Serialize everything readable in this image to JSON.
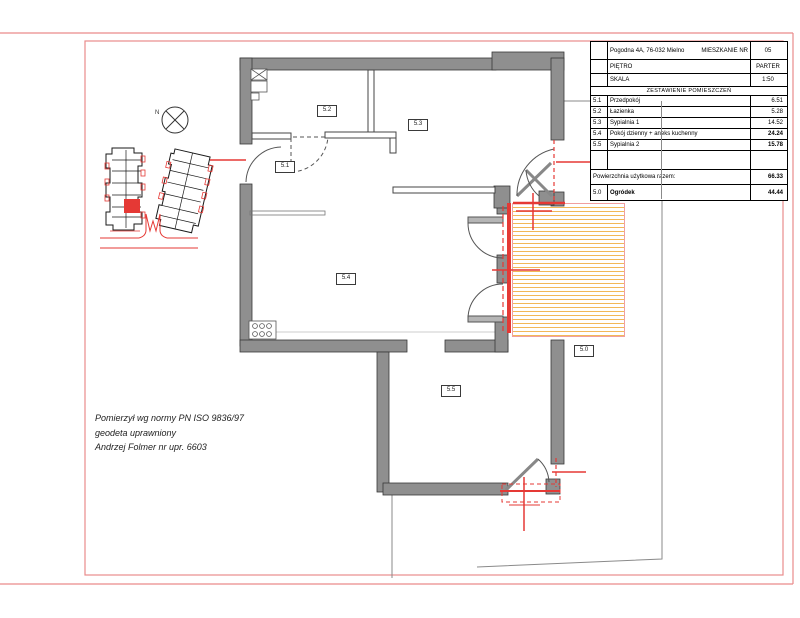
{
  "title_block": {
    "address": "Pogodna 4A, 76-032 Mielno",
    "apartment_label": "MIESZKANIE NR",
    "apartment_number": "05",
    "floor_label": "PIĘTRO",
    "floor_value": "PARTER",
    "scale_label": "SKALA",
    "scale_value": "1:50",
    "rooms_header": "ZESTAWIENIE POMIESZCZEŃ",
    "rooms": [
      {
        "id": "5.1",
        "name": "Przedpokój",
        "area": "6.51"
      },
      {
        "id": "5.2",
        "name": "Łazienka",
        "area": "5.28"
      },
      {
        "id": "5.3",
        "name": "Sypialnia 1",
        "area": "14.52"
      },
      {
        "id": "5.4",
        "name": "Pokój dzienny + aneks kuchenny",
        "area": "24.24"
      },
      {
        "id": "5.5",
        "name": "Sypialnia 2",
        "area": "15.78"
      }
    ],
    "total_label": "Powierzchnia użytkowa razem:",
    "total_area": "66.33",
    "garden": {
      "id": "5.0",
      "name": "Ogródek",
      "area": "44.44"
    }
  },
  "plan_labels": {
    "hall": "5.1",
    "bathroom": "5.2",
    "bedroom1": "5.3",
    "living": "5.4",
    "bedroom2": "5.5",
    "garden": "5.0"
  },
  "site_plan": {
    "north_label": "N"
  },
  "surveyor_note": {
    "line1": "Pomierzył wg normy  PN ISO 9836/97",
    "line2": "geodeta uprawniony",
    "line3": "Andrzej Folmer nr upr. 6603"
  },
  "colors": {
    "accent_red": "#e53935",
    "frame_pink": "#e98b8b",
    "wall_gray": "#8f8f8f",
    "terrace_stripe": "#f2b858",
    "boundary_gray": "#8a8a8a"
  }
}
